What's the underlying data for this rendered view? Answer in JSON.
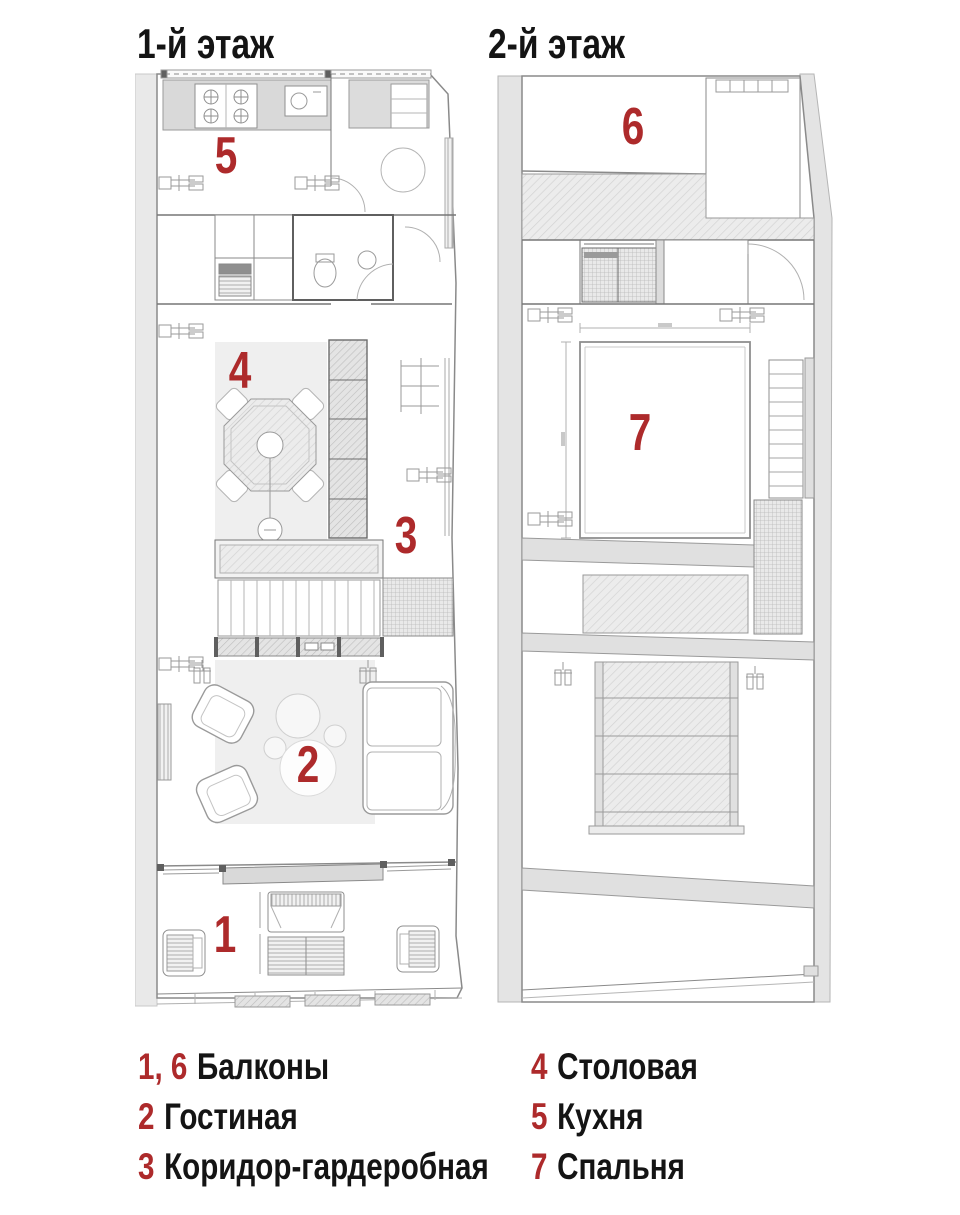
{
  "colors": {
    "accent": "#ad2a2b",
    "text": "#141414",
    "wall": "#e2e2e2"
  },
  "titles": {
    "floor1": "1-й этаж",
    "floor2": "2-й этаж"
  },
  "plans": {
    "floor1": {
      "markers": [
        {
          "number": "5"
        },
        {
          "number": "4"
        },
        {
          "number": "3"
        },
        {
          "number": "2"
        },
        {
          "number": "1"
        }
      ]
    },
    "floor2": {
      "markers": [
        {
          "number": "6"
        },
        {
          "number": "7"
        }
      ]
    }
  },
  "legend": {
    "columns": [
      {
        "items": [
          {
            "number": "1, 6",
            "label": "Балконы"
          },
          {
            "number": "2",
            "label": "Гостиная"
          },
          {
            "number": "3",
            "label": "Коридор-гардеробная"
          }
        ]
      },
      {
        "items": [
          {
            "number": "4",
            "label": "Столовая"
          },
          {
            "number": "5",
            "label": "Кухня"
          },
          {
            "number": "7",
            "label": "Спальня"
          }
        ]
      }
    ]
  }
}
